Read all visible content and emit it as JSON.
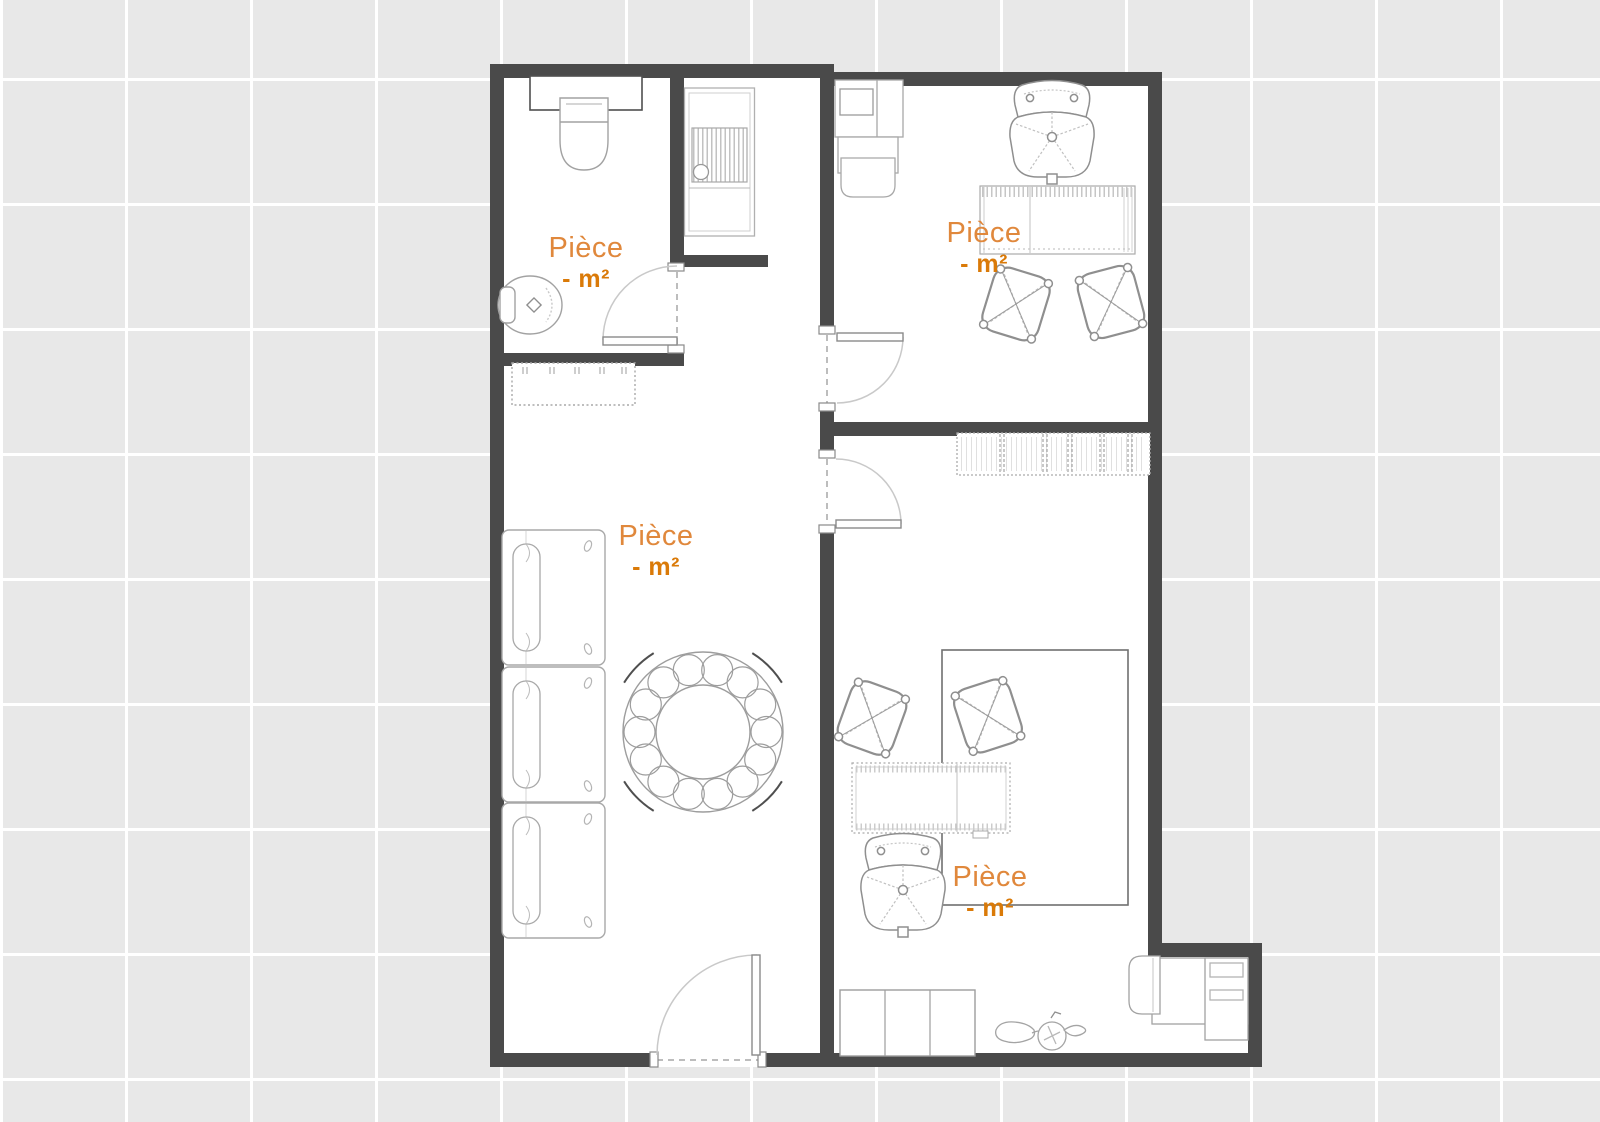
{
  "plan": {
    "background_color": "#e8e8e8",
    "grid_color": "#ffffff",
    "wall_color": "#4a4a4a",
    "floor_color": "#ffffff",
    "room_name_color": "#e0883c",
    "room_area_color": "#da7a08"
  },
  "rooms": [
    {
      "id": "bathroom",
      "name": "Pièce",
      "area": "- m²"
    },
    {
      "id": "office-top-right",
      "name": "Pièce",
      "area": "- m²"
    },
    {
      "id": "living-room",
      "name": "Pièce",
      "area": "- m²"
    },
    {
      "id": "office-bottom-right",
      "name": "Pièce",
      "area": "- m²"
    }
  ],
  "doors": [
    "bathroom-door",
    "office-top-right-door",
    "office-bottom-right-door",
    "entrance-door"
  ],
  "furniture_icons": [
    "sink-counter",
    "washbasin",
    "toilet",
    "washing-machine",
    "radiator",
    "single-bed",
    "single-bed",
    "single-bed",
    "round-table",
    "cabinet-unit",
    "office-chair",
    "desk",
    "stool",
    "stool",
    "shelf-unit",
    "stool",
    "stool",
    "rug-zone",
    "desk",
    "office-chair",
    "wardrobe",
    "scooter",
    "alcove-desk",
    "desk-chair"
  ]
}
